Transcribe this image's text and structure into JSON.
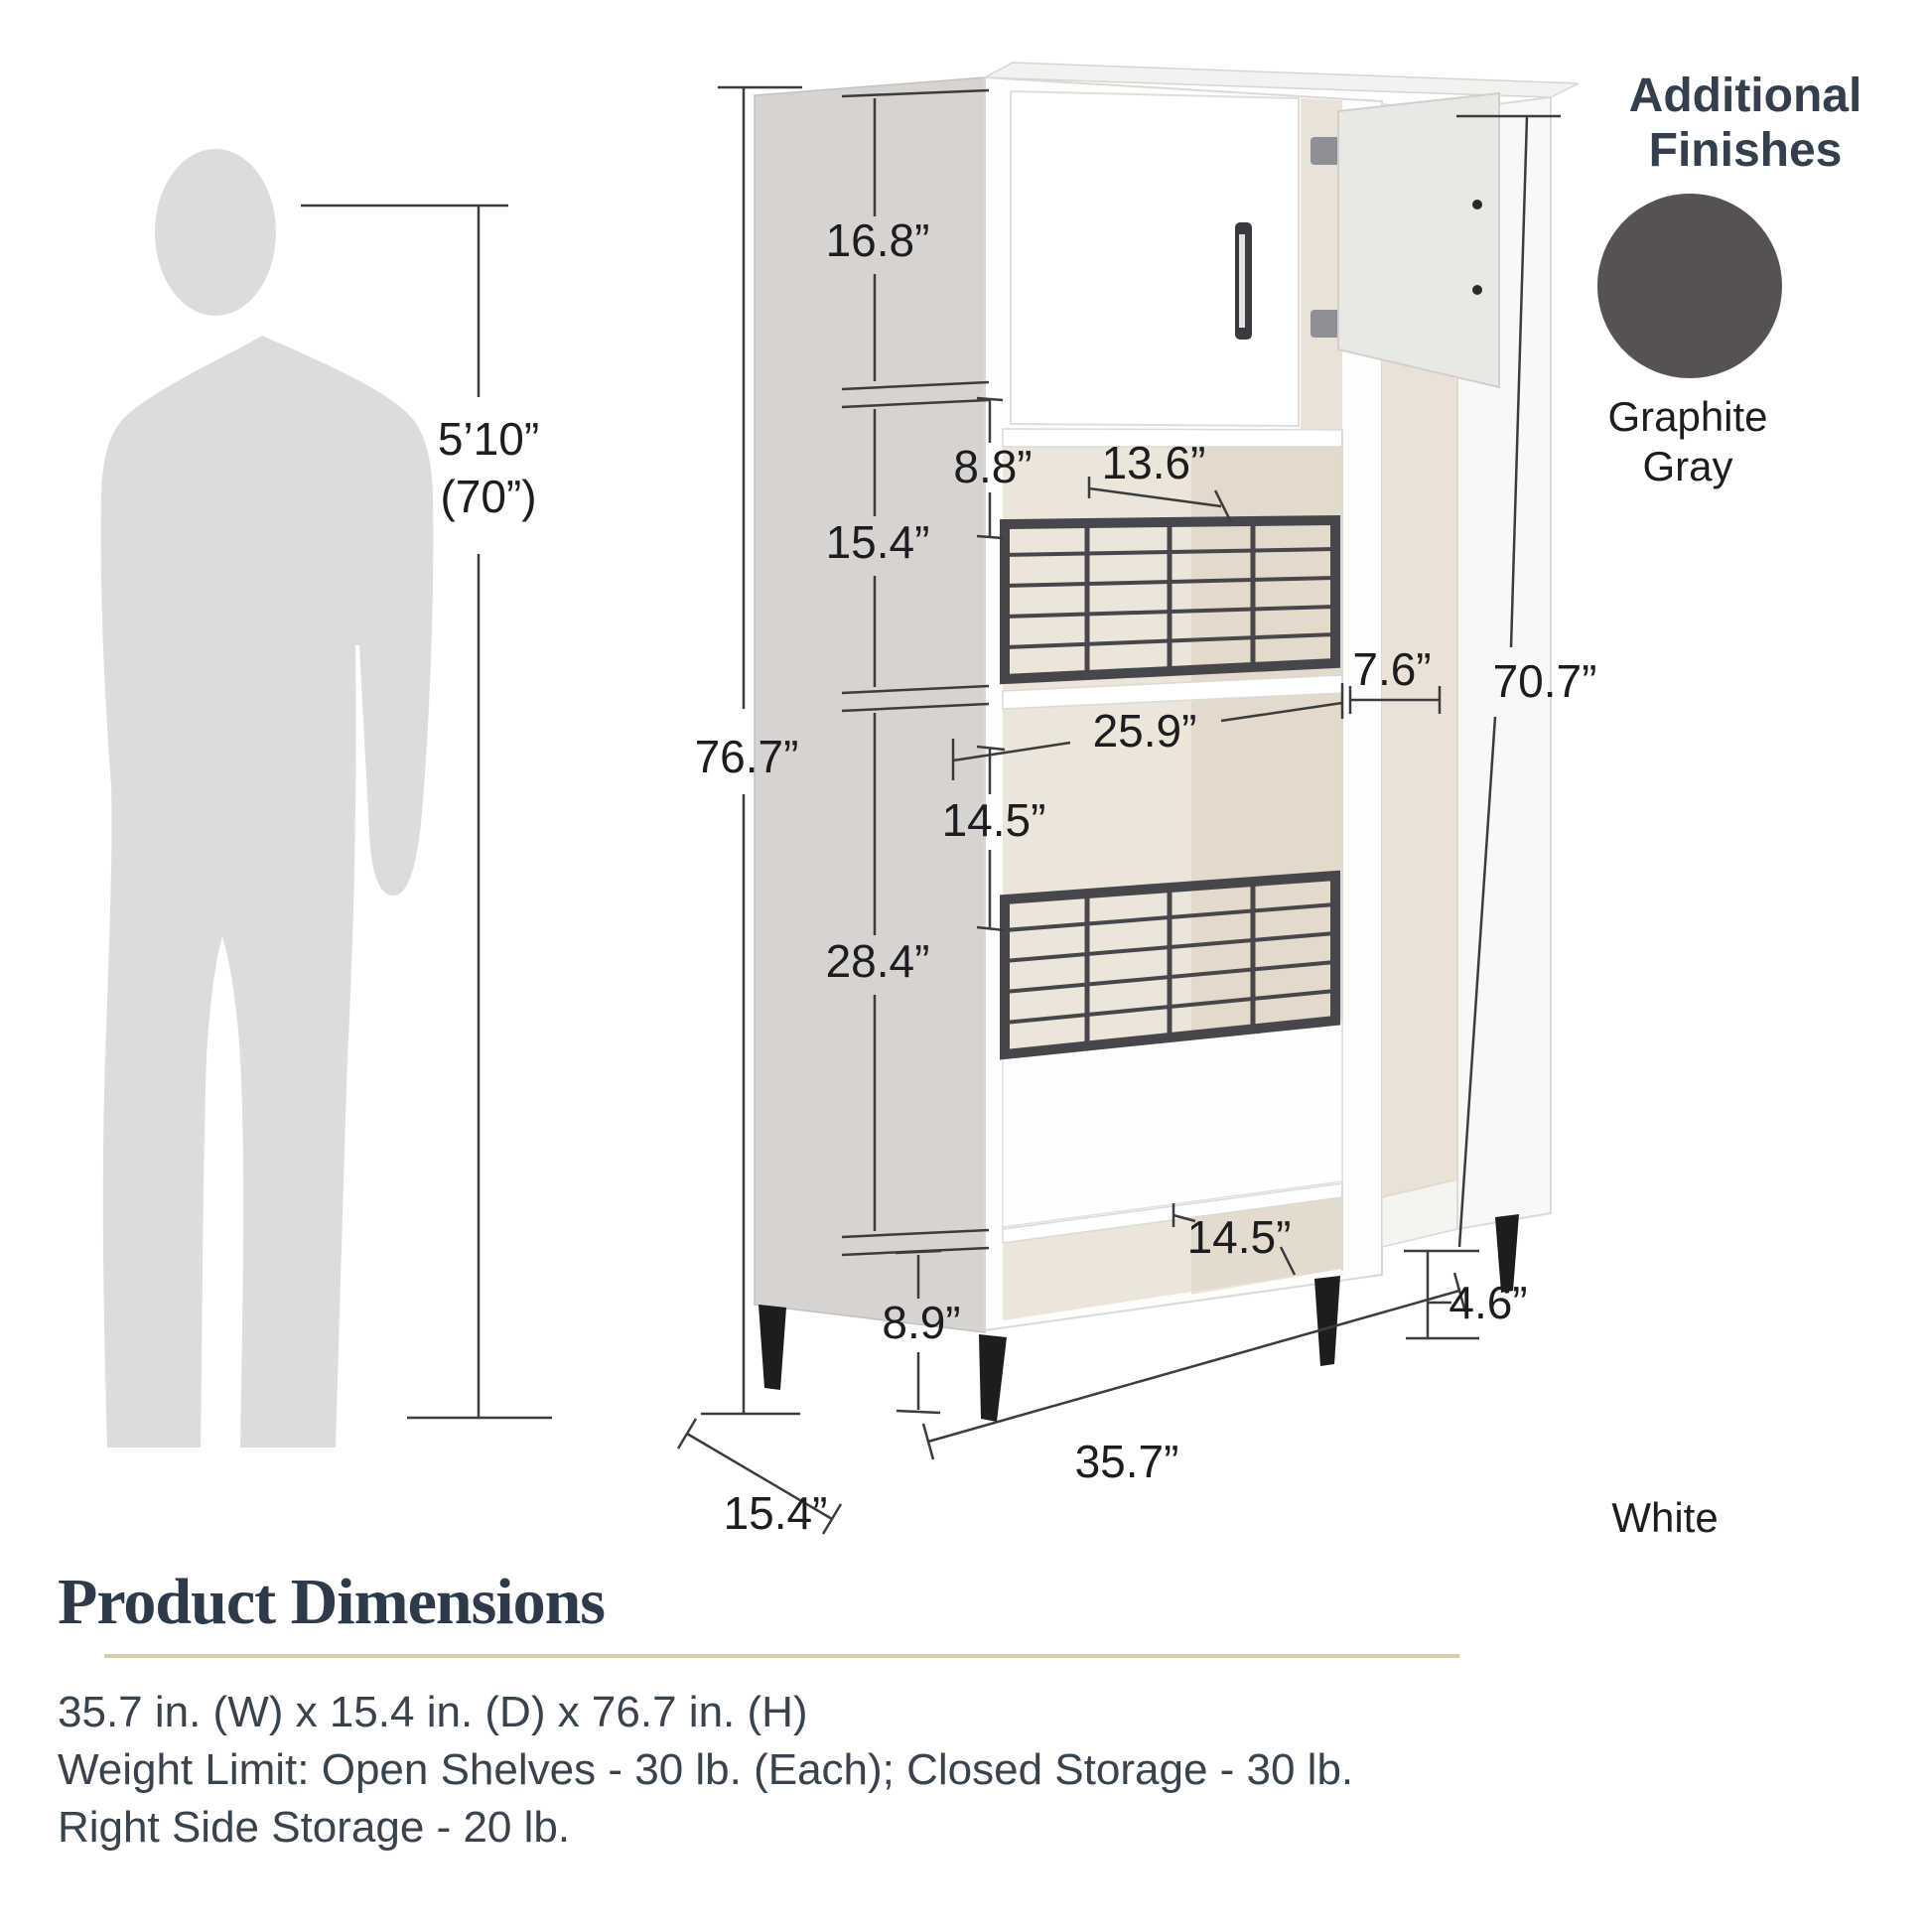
{
  "finishes": {
    "title_line1": "Additional",
    "title_line2": "Finishes",
    "swatch_color": "#565153",
    "swatch_name_line1": "Graphite",
    "swatch_name_line2": "Gray",
    "base_finish": "White"
  },
  "person": {
    "height_ft": "5’10”",
    "height_in": "(70”)"
  },
  "dims": {
    "top_cabinet_h": "16.8”",
    "shelf2_h": "15.4”",
    "basket_top_offset": "8.8”",
    "basket_w": "13.6”",
    "total_h": "76.7”",
    "opening_w": "25.9”",
    "mid_opening_h": "14.5”",
    "side_w": "7.6”",
    "side_h": "70.7”",
    "lower_h": "28.4”",
    "bottom_shelf_h": "8.9”",
    "bottom_opening_w": "14.5”",
    "leg_h": "4.6”",
    "total_w": "35.7”",
    "total_d": "15.4”"
  },
  "footer": {
    "title": "Product Dimensions",
    "size_line": "35.7 in. (W) x 15.4 in. (D) x 76.7 in. (H)",
    "weight_line": "Weight Limit: Open Shelves - 30 lb. (Each); Closed Storage - 30 lb.",
    "side_line": "Right Side Storage - 20 lb."
  }
}
